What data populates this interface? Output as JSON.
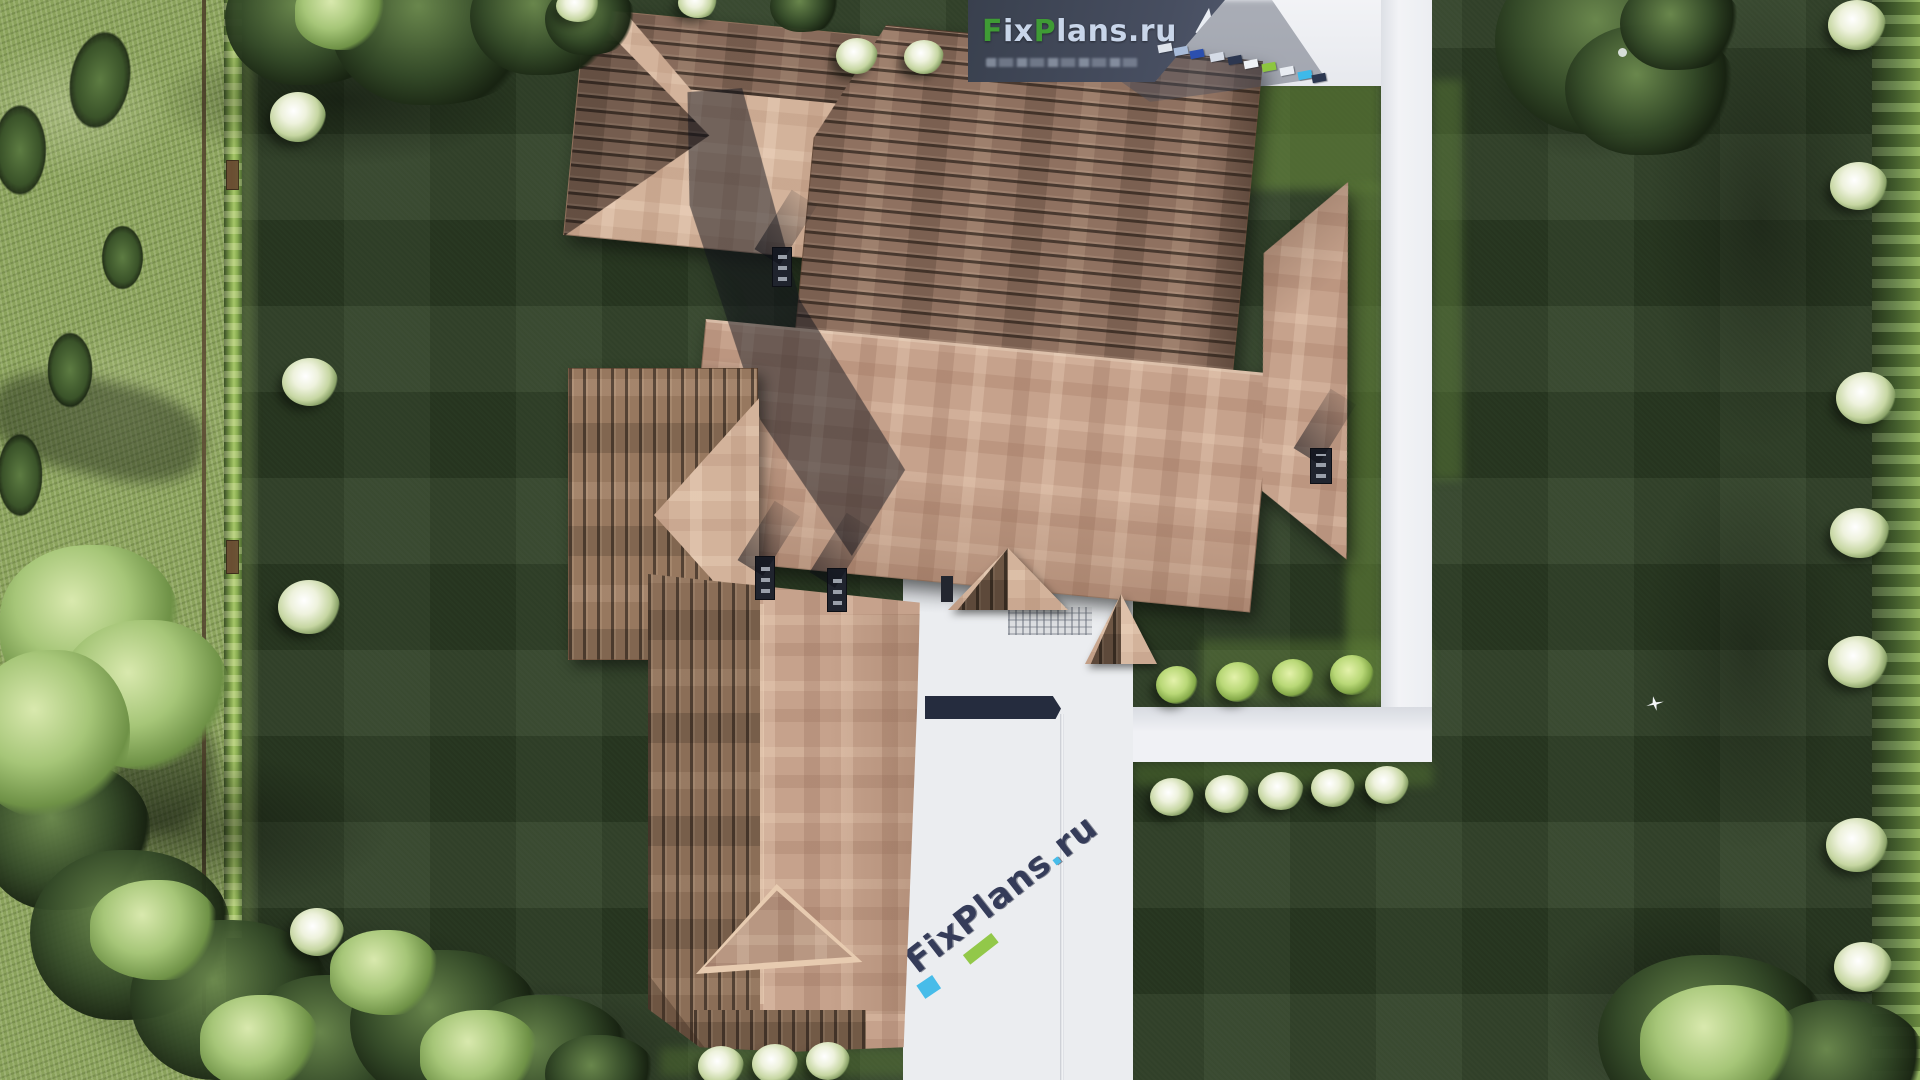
{
  "scene": {
    "description": "Aerial top-down 3D architectural render of a hip-roofed house with landscaped lawn, hedges, trees and white concrete paths",
    "logo_banner": {
      "text_full": "FixPlans.ru",
      "parts": {
        "f": "F",
        "ix": "ix",
        "p": "P",
        "lans": "lans",
        "dot_ru": ".ru"
      }
    },
    "pavement_watermark": {
      "text_full": "FixPlans.ru",
      "name": "FixPlans",
      "dot": ".",
      "tld": "ru"
    },
    "banner_dash_colors": [
      "#dfe4ec",
      "#a8bcda",
      "#2b4fae",
      "#d5dbe6",
      "#2c3750",
      "#eef1f5",
      "#8dc63f",
      "#e8ecf2",
      "#3db9e9",
      "#2c3750"
    ],
    "palette": {
      "lawn": "#2a3a22",
      "lawn_check": "#33452a",
      "meadow": "#8ba35c",
      "hedge": "#86ab50",
      "roof_plank": "#8f7160",
      "roof_shingle": "#c6a28c",
      "pavement": "#edeff2",
      "banner_slate": "#3f4656",
      "logo_green": "#3f9b35",
      "logo_blue": "#c9d6ea",
      "watermark_navy": "#2a3150",
      "accent_green": "#8dc63f",
      "accent_cyan": "#3db9e9",
      "shadow_band_navy": "#252c3e"
    }
  }
}
